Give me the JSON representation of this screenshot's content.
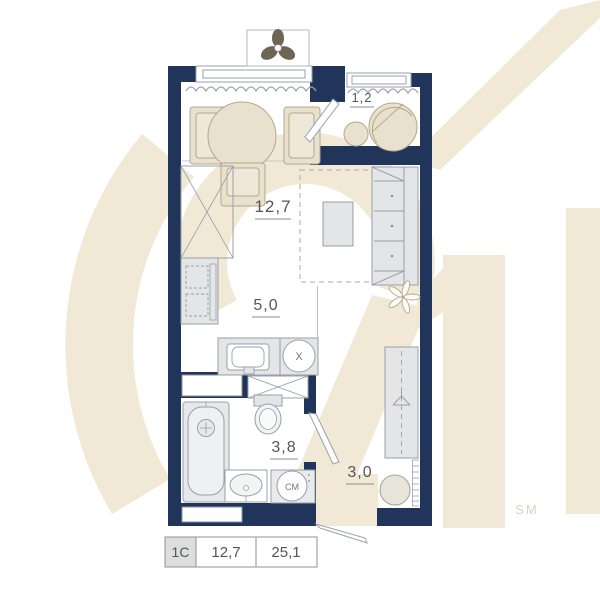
{
  "watermark": {
    "logo_text": "21",
    "sm_label": "SM"
  },
  "rooms": {
    "balcony": {
      "name": "balcony",
      "area": "1,2"
    },
    "living": {
      "name": "living-room",
      "area": "12,7"
    },
    "kitchen": {
      "name": "kitchen",
      "area": "5,0"
    },
    "bathroom": {
      "name": "bathroom",
      "area": "3,8"
    },
    "hallway": {
      "name": "hallway",
      "area": "3,0"
    }
  },
  "appliances": {
    "washer_label": "СМ",
    "hob_label": "X"
  },
  "legend": {
    "unit_type": "1C",
    "living_area": "12,7",
    "total_area": "25,1"
  },
  "colors": {
    "wall": "#21345a",
    "watermark_beige": "#f1e9d6",
    "furniture_fill": "#e4e5e7",
    "furniture_stroke": "#98a0aa",
    "loggia_furniture_fill": "#e9e1cd",
    "loggia_furniture_stroke": "#b2a88c",
    "label_text": "#54565a"
  }
}
